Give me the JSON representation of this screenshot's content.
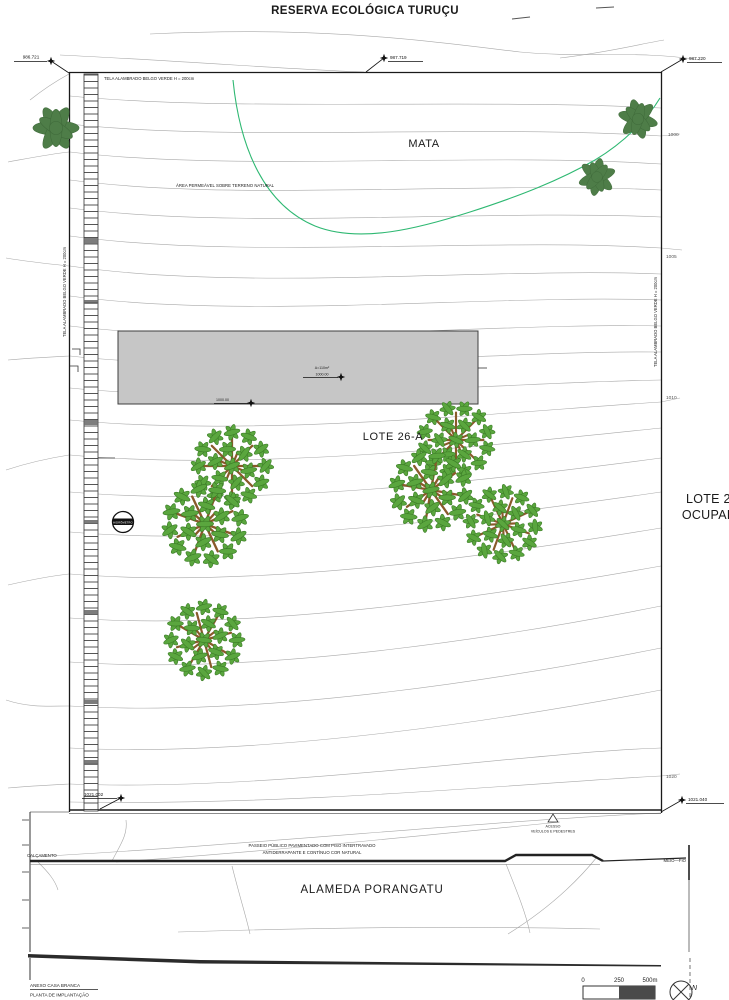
{
  "title": "RESERVA ECOLÓGICA TURUÇU",
  "areas": {
    "mata": "MATA",
    "area_permeavel": "ÁREA PERMEÁVEL SOBRE TERRENO NATURAL",
    "lote26a": "LOTE 26-A",
    "lote25_line1": "LOTE 25",
    "lote25_line2": "OCUPADO"
  },
  "fence": {
    "top": "TELA ALAMBRADO BELGO VERDE H = 200cm",
    "left": "TELA ALAMBRADO BELGO VERDE H = 200cm",
    "right": "TELA ALAMBRADO BELGO VERDE H = 200cm"
  },
  "survey_points": {
    "top_left": "986.721",
    "top_mid": "987.719",
    "top_right": "987.220",
    "bottom_left": "1021.002",
    "bottom_right": "1021.040"
  },
  "contour_labels": {
    "c1000": "1000",
    "c1005": "1005",
    "c1010": "1010",
    "c1020": "1020"
  },
  "building": {
    "area": "A=110m²",
    "level": "1000.00",
    "level_front": "1000.00"
  },
  "hidrometro": "HIDRÔMETRO",
  "street": {
    "name": "ALAMEDA PORANGATU",
    "calcamento": "CALÇAMENTO",
    "meio_fio": "MEIO—FIO",
    "acesso1": "ACESSO",
    "acesso2": "VEÍCULOS E PEDESTRES",
    "passeio1": "PASSEIO PÚBLICO PAVIMENTADO COM PISO INTERTRAVADO",
    "passeio2": "ANTIDERRAPANTE E CONTÍNUO COR NATURAL"
  },
  "titleblock": {
    "line1": "ANEXO CASA BRANCA",
    "line2": "PLANTA DE IMPLANTAÇÃO"
  },
  "scalebar": {
    "zero": "0",
    "mid": "250",
    "max": "500m",
    "north": "N"
  },
  "colors": {
    "contour": "#a9a9a9",
    "boundary": "#1a1a1a",
    "green_line": "#2eb872",
    "tree_dark": "#4e7d48",
    "leaf": "#5aa63e",
    "branch": "#8a5a2b",
    "building_fill": "#c6c6c6"
  }
}
